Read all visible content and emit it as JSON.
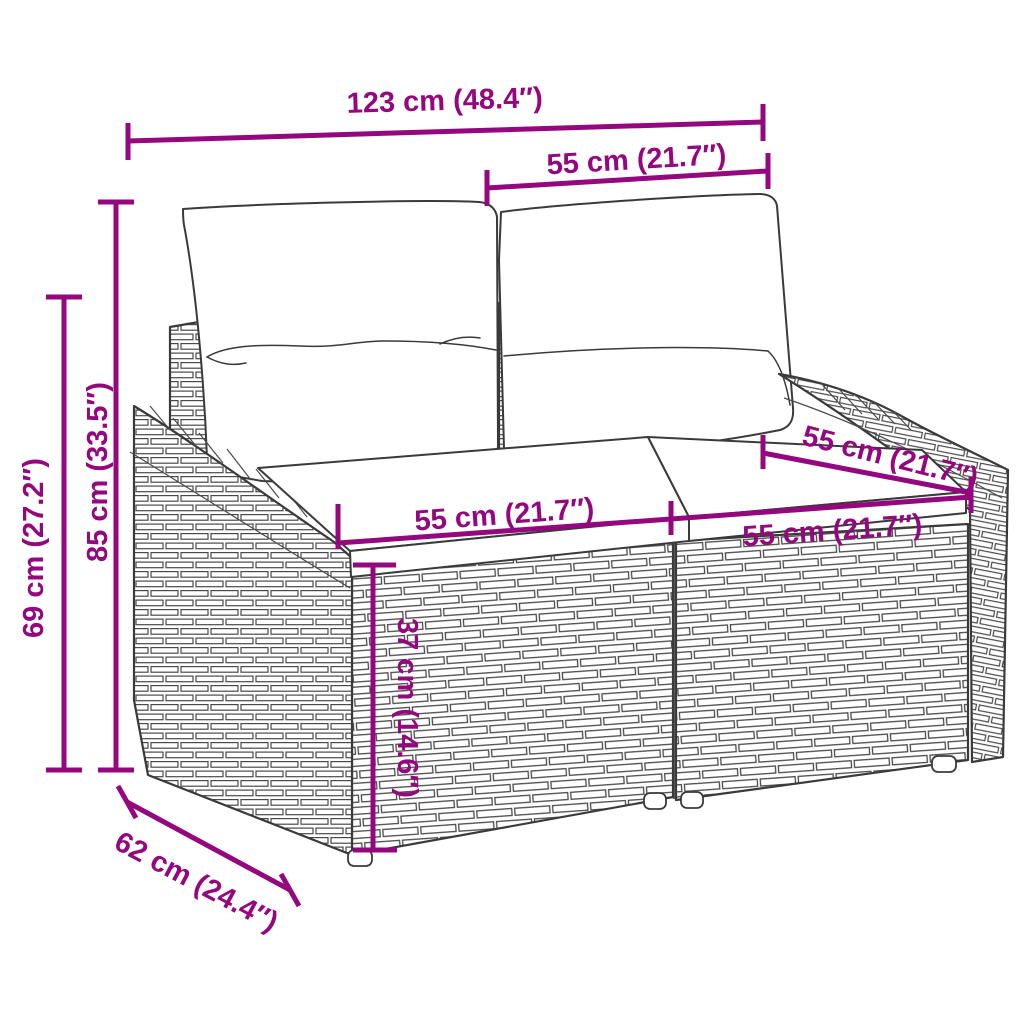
{
  "diagram": {
    "subject": "2-seater poly rattan garden sofa with back and seat cushions",
    "accent_color": "#94077E",
    "outline_color": "#3A3A3A",
    "background_color": "#FFFFFF",
    "dimensions": [
      {
        "id": "overall-width",
        "label": "123 cm (48.4″)"
      },
      {
        "id": "backrest-section-width",
        "label": "55 cm (21.7″)"
      },
      {
        "id": "total-height",
        "label": "85 cm (33.5″)"
      },
      {
        "id": "armrest-height",
        "label": "69 cm (27.2″)"
      },
      {
        "id": "seat-width-left",
        "label": "55 cm (21.7″)"
      },
      {
        "id": "seat-width-right",
        "label": "55 cm (21.7″)"
      },
      {
        "id": "seat-depth-right",
        "label": "55 cm (21.7″)"
      },
      {
        "id": "seat-height",
        "label": "37 cm (14.6″)"
      },
      {
        "id": "overall-depth",
        "label": "62 cm (24.4″)"
      }
    ]
  }
}
